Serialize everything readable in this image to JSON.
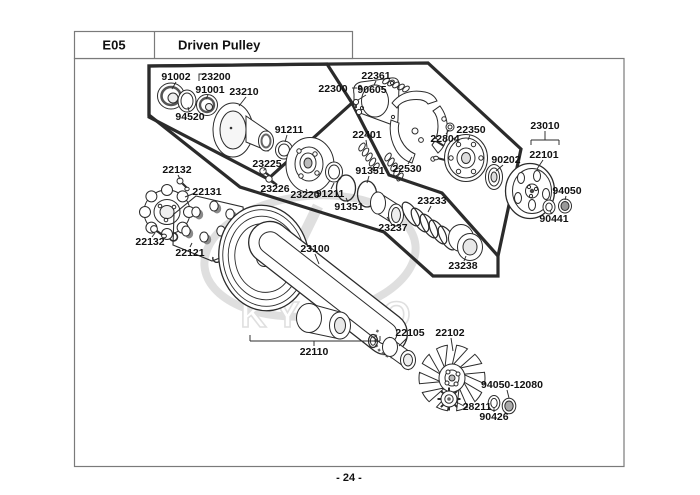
{
  "header": {
    "code": "E05",
    "title": "Driven Pulley"
  },
  "footer": {
    "page_number": "- 24 -"
  },
  "watermark": {
    "brand": "KYMCO"
  },
  "colors": {
    "line": "#2b2b2b",
    "frame": "#7a7a7a",
    "watermark": "#c6c6c6",
    "text": "#111111"
  },
  "part_labels": {
    "p91002": "91002",
    "p23200": "23200",
    "p91001": "91001",
    "p23210": "23210",
    "p94520": "94520",
    "p91211_top": "91211",
    "p23225": "23225",
    "p23226": "23226",
    "p23220": "23220",
    "p91211_mid": "91211",
    "p91351_low": "91351",
    "p91351_up": "91351",
    "p22300": "22300",
    "p90605": "90605",
    "p22361": "22361",
    "p22401": "22401",
    "p22530": "22530",
    "p22804": "22804",
    "p22350": "22350",
    "p90202": "90202",
    "p23010": "23010",
    "p22101": "22101",
    "p94050": "94050",
    "p90441": "90441",
    "p23233": "23233",
    "p23237": "23237",
    "p23238": "23238",
    "p23100": "23100",
    "p22110": "22110",
    "p22105": "22105",
    "p22102": "22102",
    "p94050_12080": "94050-12080",
    "p28211": "28211",
    "p90426": "90426",
    "p22132_top": "22132",
    "p22131": "22131",
    "p22132_bot": "22132",
    "p22121": "22121"
  }
}
